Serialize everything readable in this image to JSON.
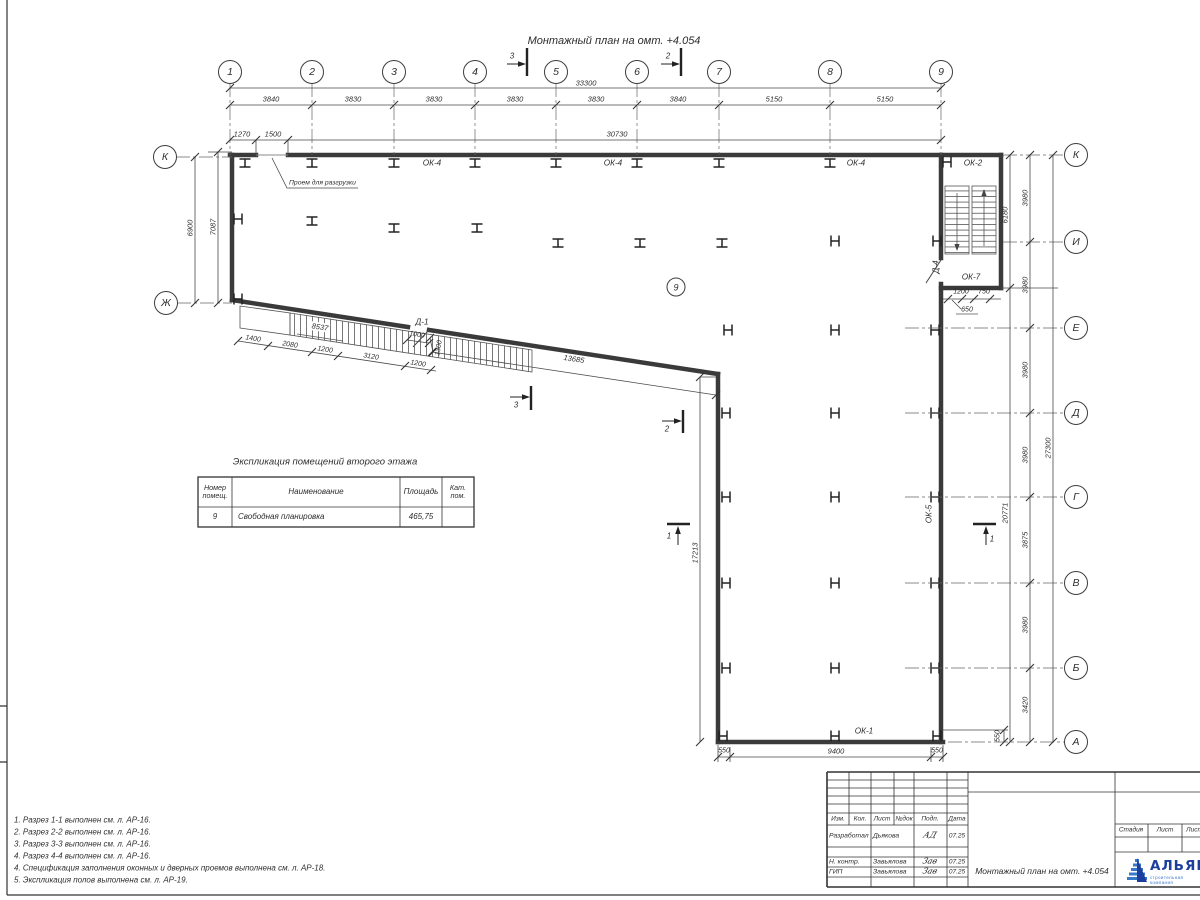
{
  "sheet": {
    "title": "Монтажный план на омт. +4.054"
  },
  "axes": {
    "columns": [
      "1",
      "2",
      "3",
      "4",
      "5",
      "6",
      "7",
      "8",
      "9"
    ],
    "rows_right": [
      "К",
      "И",
      "Е",
      "Д",
      "Г",
      "В",
      "Б",
      "А"
    ],
    "rows_left": [
      "К",
      "Ж"
    ]
  },
  "dims": {
    "top_total": "33300",
    "top_segments": [
      "3840",
      "3830",
      "3830",
      "3830",
      "3830",
      "3840",
      "5150",
      "5150"
    ],
    "top_sub": [
      "1270",
      "1500",
      "30730"
    ],
    "left_vertical": [
      "6900",
      "7087"
    ],
    "right_stair": [
      "6180",
      "20771"
    ],
    "right_segments": [
      "3980",
      "3980",
      "3980",
      "3980",
      "3875",
      "3980",
      "3420"
    ],
    "right_total": "27300",
    "stair_bottom": [
      "1200",
      "750",
      "650"
    ],
    "bottom": [
      "550",
      "9400",
      "550"
    ],
    "bottom_right": "550",
    "leg_height": "17213",
    "ramp_total": "8537",
    "ramp_segments": [
      "1400",
      "2080",
      "1200",
      "3120",
      "1200"
    ],
    "door_opening": [
      "1000",
      "1300"
    ],
    "diagonal": "13685"
  },
  "labels": {
    "ok4": "ОК-4",
    "ok2": "ОК-2",
    "ok7": "ОК-7",
    "ok5": "ОК-5",
    "ok1": "ОК-1",
    "d1": "Д-1",
    "d4": "Д-4",
    "opening_note": "Проем для разгрузки",
    "room_tag": "9"
  },
  "sections": {
    "s1": "1",
    "s2": "2",
    "s3": "3"
  },
  "table": {
    "title": "Экспликация помещений второго этажа",
    "headers": [
      "Номер помещ.",
      "Наименование",
      "Площадь",
      "Кат. пом."
    ],
    "rows": [
      [
        "9",
        "Свободная планировка",
        "465,75",
        ""
      ]
    ]
  },
  "notes": [
    "1. Разрез 1-1 выполнен см. л. АР-16.",
    "2. Разрез 2-2 выполнен см. л. АР-16.",
    "3. Разрез 3-3 выполнен см. л. АР-16.",
    "4. Разрез 4-4 выполнен см. л. АР-16.",
    "4. Спецификация заполнения оконных и дверных проемов выполнена см. л. АР-18.",
    "5. Экспликация полов выполнена см. л. АР-19."
  ],
  "titleblock": {
    "columns": [
      "Изм.",
      "Кол.",
      "Лист",
      "№док",
      "Подп.",
      "Дата"
    ],
    "rows": [
      {
        "role": "Разработал",
        "name": "Дьякова",
        "sign": "АД",
        "date": "07.25"
      },
      {
        "role": "Н. контр.",
        "name": "Завьялова",
        "sign": "Зав",
        "date": "07.25"
      },
      {
        "role": "ГИП",
        "name": "Завьялова",
        "sign": "Зав",
        "date": "07.25"
      }
    ],
    "doc_title": "Монтажный план на омт. +4.054",
    "stage_headers": [
      "Стадия",
      "Лист",
      "Листов"
    ],
    "logo": {
      "name": "АЛЬЯНС",
      "tagline": "строительная компания"
    }
  },
  "colors": {
    "line": "#3a3a3a",
    "accent_blue": "#1c3f9e",
    "accent_light": "#3a78c9"
  }
}
